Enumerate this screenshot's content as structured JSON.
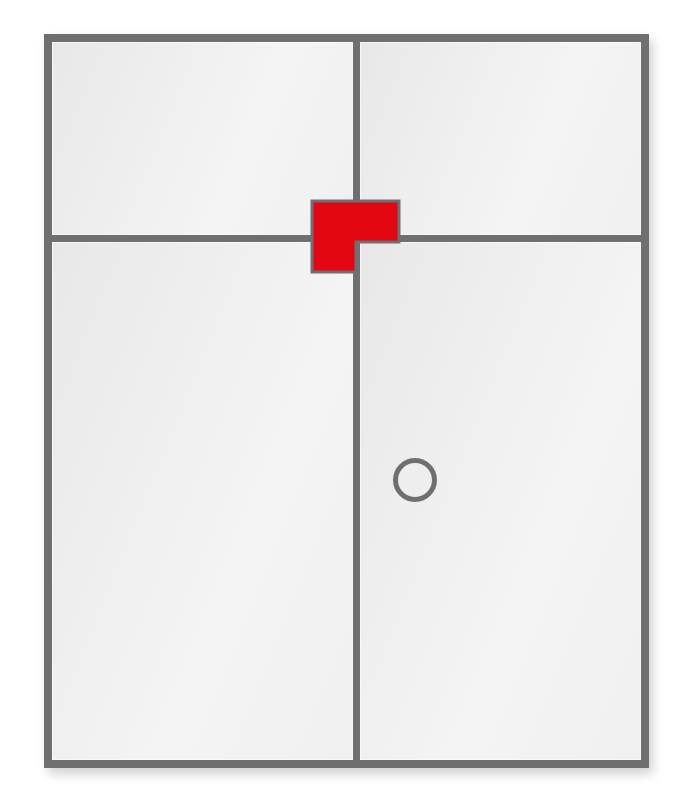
{
  "diagram": {
    "name": "double-door-with-transom",
    "colors": {
      "background": "#ffffff",
      "frame_gray": "#6f6f6f",
      "panel_dark": "#e8e8e8",
      "panel_light": "#f4f4f4",
      "marker_red": "#e30613"
    },
    "elements": {
      "panels": [
        {
          "id": "transom-panel-left"
        },
        {
          "id": "transom-panel-right"
        },
        {
          "id": "door-leaf-left"
        },
        {
          "id": "door-leaf-right"
        }
      ],
      "marker": {
        "id": "corner-selection-marker",
        "shape": "l-shape"
      },
      "knob": {
        "id": "door-knob",
        "shape": "circle"
      }
    }
  }
}
